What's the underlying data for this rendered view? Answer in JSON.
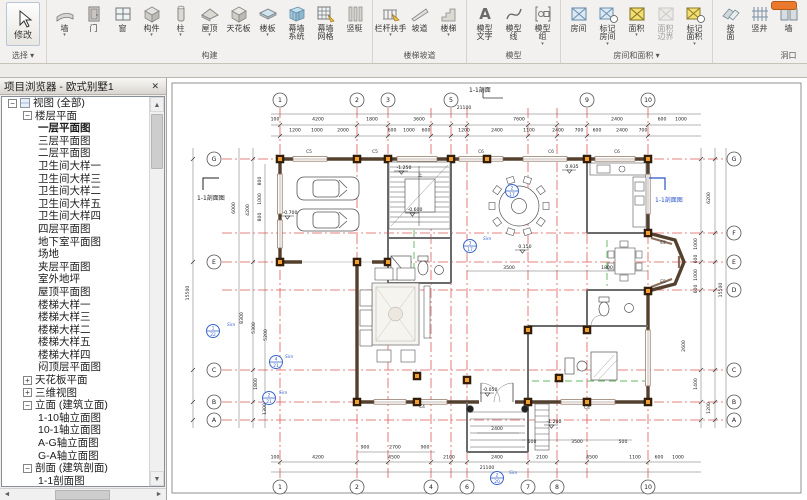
{
  "ribbon": {
    "modify": {
      "label": "修改",
      "select_label": "选择",
      "icon": "modify-cursor-icon"
    },
    "groups": [
      {
        "label": "构建",
        "arrow": false,
        "items": [
          {
            "label": "墙",
            "icon": "wall-icon",
            "arrow": true
          },
          {
            "label": "门",
            "icon": "door-icon",
            "arrow": false
          },
          {
            "label": "窗",
            "icon": "window-icon",
            "arrow": false
          },
          {
            "label": "构件",
            "icon": "component-icon",
            "arrow": true
          },
          {
            "label": "柱",
            "icon": "column-icon",
            "arrow": true
          },
          {
            "label": "屋顶",
            "icon": "roof-icon",
            "arrow": true
          },
          {
            "label": "天花板",
            "icon": "ceiling-icon",
            "arrow": false
          },
          {
            "label": "楼板",
            "icon": "floor-icon",
            "arrow": true
          },
          {
            "label": "幕墙\n系统",
            "icon": "curtain-system-icon",
            "arrow": false
          },
          {
            "label": "幕墙\n网格",
            "icon": "curtain-grid-icon",
            "arrow": false
          },
          {
            "label": "竖梃",
            "icon": "mullion-icon",
            "arrow": false
          }
        ]
      },
      {
        "label": "楼梯坡道",
        "arrow": false,
        "items": [
          {
            "label": "栏杆扶手",
            "icon": "railing-icon",
            "arrow": true
          },
          {
            "label": "坡道",
            "icon": "ramp-icon",
            "arrow": false
          },
          {
            "label": "楼梯",
            "icon": "stair-icon",
            "arrow": true
          }
        ]
      },
      {
        "label": "模型",
        "arrow": false,
        "items": [
          {
            "label": "模型\n文字",
            "icon": "model-text-icon",
            "arrow": false
          },
          {
            "label": "模型\n线",
            "icon": "model-line-icon",
            "arrow": false
          },
          {
            "label": "模型\n组",
            "icon": "model-group-icon",
            "arrow": true
          }
        ]
      },
      {
        "label": "房间和面积",
        "arrow": true,
        "items": [
          {
            "label": "房间",
            "icon": "room-icon",
            "arrow": false
          },
          {
            "label": "标记\n房间",
            "icon": "room-tag-icon",
            "arrow": true
          },
          {
            "label": "面积",
            "icon": "area-icon",
            "arrow": true
          },
          {
            "label": "面积\n边界",
            "icon": "area-boundary-icon",
            "arrow": false,
            "disabled": true
          },
          {
            "label": "标记\n面积",
            "icon": "area-tag-icon",
            "arrow": true
          }
        ]
      },
      {
        "label": "洞口",
        "arrow": false,
        "items": [
          {
            "label": "按\n面",
            "icon": "opening-by-face-icon",
            "arrow": false
          },
          {
            "label": "竖井",
            "icon": "shaft-icon",
            "arrow": false
          },
          {
            "label": "墙",
            "icon": "wall-opening-icon",
            "arrow": false
          },
          {
            "label": "垂直",
            "icon": "vertical-opening-icon",
            "arrow": false
          },
          {
            "label": "老虎窗",
            "icon": "dormer-icon",
            "arrow": false
          }
        ]
      },
      {
        "label": "基准",
        "arrow": false,
        "items": [
          {
            "label": "轴网",
            "icon": "grid-icon",
            "arrow": false
          }
        ]
      }
    ]
  },
  "browser": {
    "title": "项目浏览器 - 欧式别墅1",
    "close_label": "✕",
    "tree": [
      {
        "t": "视图 (全部)",
        "lvl": 0,
        "exp": "-",
        "ico": true
      },
      {
        "t": "楼层平面",
        "lvl": 1,
        "exp": "-"
      },
      {
        "t": "一层平面图",
        "lvl": 2,
        "bold": true
      },
      {
        "t": "三层平面图",
        "lvl": 2
      },
      {
        "t": "二层平面图",
        "lvl": 2
      },
      {
        "t": "卫生间大样一",
        "lvl": 2
      },
      {
        "t": "卫生间大样三",
        "lvl": 2
      },
      {
        "t": "卫生间大样二",
        "lvl": 2
      },
      {
        "t": "卫生间大样五",
        "lvl": 2
      },
      {
        "t": "卫生间大样四",
        "lvl": 2
      },
      {
        "t": "四层平面图",
        "lvl": 2
      },
      {
        "t": "地下室平面图",
        "lvl": 2
      },
      {
        "t": "场地",
        "lvl": 2
      },
      {
        "t": "夹层平面图",
        "lvl": 2
      },
      {
        "t": "室外地坪",
        "lvl": 2
      },
      {
        "t": "屋顶平面图",
        "lvl": 2
      },
      {
        "t": "楼梯大样一",
        "lvl": 2
      },
      {
        "t": "楼梯大样三",
        "lvl": 2
      },
      {
        "t": "楼梯大样二",
        "lvl": 2
      },
      {
        "t": "楼梯大样五",
        "lvl": 2
      },
      {
        "t": "楼梯大样四",
        "lvl": 2
      },
      {
        "t": "闷顶层平面图",
        "lvl": 2
      },
      {
        "t": "天花板平面",
        "lvl": 1,
        "exp": "+"
      },
      {
        "t": "三维视图",
        "lvl": 1,
        "exp": "+"
      },
      {
        "t": "立面 (建筑立面)",
        "lvl": 1,
        "exp": "-"
      },
      {
        "t": "1-10轴立面图",
        "lvl": 2
      },
      {
        "t": "10-1轴立面图",
        "lvl": 2
      },
      {
        "t": "A-G轴立面图",
        "lvl": 2
      },
      {
        "t": "G-A轴立面图",
        "lvl": 2
      },
      {
        "t": "剖面 (建筑剖面)",
        "lvl": 1,
        "exp": "-"
      },
      {
        "t": "1-1剖面图",
        "lvl": 2
      }
    ]
  },
  "plan": {
    "colors": {
      "grid_line": "#e05a5a",
      "callout_blue": "#3a66cc",
      "column_fill": "#f0a030",
      "wall": "#54402e"
    },
    "grids_v": [
      {
        "n": "1",
        "x": 113,
        "top": true,
        "bottom": true
      },
      {
        "n": "2",
        "x": 190,
        "top": true,
        "bottom": true
      },
      {
        "n": "3",
        "x": 221,
        "top": true,
        "bottom": false
      },
      {
        "n": "4",
        "x": 264,
        "top": false,
        "bottom": true
      },
      {
        "n": "5",
        "x": 284,
        "top": true,
        "bottom": false
      },
      {
        "n": "6",
        "x": 300,
        "top": false,
        "bottom": true
      },
      {
        "n": "7",
        "x": 361,
        "top": false,
        "bottom": true
      },
      {
        "n": "8",
        "x": 390,
        "top": false,
        "bottom": true
      },
      {
        "n": "9",
        "x": 420,
        "top": true,
        "bottom": false
      },
      {
        "n": "10",
        "x": 481,
        "top": true,
        "bottom": true
      }
    ],
    "grids_h": [
      {
        "n": "G",
        "y": 81,
        "left": true,
        "right": true
      },
      {
        "n": "F",
        "y": 155,
        "left": false,
        "right": true
      },
      {
        "n": "E",
        "y": 184,
        "left": true,
        "right": true
      },
      {
        "n": "D",
        "y": 212,
        "left": false,
        "right": true
      },
      {
        "n": "C",
        "y": 292,
        "left": true,
        "right": true
      },
      {
        "n": "B",
        "y": 324,
        "left": true,
        "right": true
      },
      {
        "n": "A",
        "y": 342,
        "left": true,
        "right": true
      }
    ],
    "dims": [
      {
        "x": 297,
        "y": 31,
        "t": "21100"
      },
      {
        "x": 108,
        "y": 42.5,
        "t": "100"
      },
      {
        "x": 151,
        "y": 42.5,
        "t": "4200"
      },
      {
        "x": 205,
        "y": 42.5,
        "t": "1800"
      },
      {
        "x": 252,
        "y": 42.5,
        "t": "3600"
      },
      {
        "x": 352,
        "y": 42.5,
        "t": "7600"
      },
      {
        "x": 450,
        "y": 42.5,
        "t": "2400"
      },
      {
        "x": 495,
        "y": 42.5,
        "t": "600"
      },
      {
        "x": 514,
        "y": 42.5,
        "t": "1000"
      },
      {
        "x": 128,
        "y": 53.5,
        "t": "1200"
      },
      {
        "x": 150,
        "y": 53.5,
        "t": "1000"
      },
      {
        "x": 176,
        "y": 53.5,
        "t": "2000"
      },
      {
        "x": 225,
        "y": 53.5,
        "t": "600"
      },
      {
        "x": 242,
        "y": 53.5,
        "t": "1000"
      },
      {
        "x": 259,
        "y": 53.5,
        "t": "600"
      },
      {
        "x": 297,
        "y": 53.5,
        "t": "1200"
      },
      {
        "x": 330,
        "y": 53.5,
        "t": "2400"
      },
      {
        "x": 362,
        "y": 53.5,
        "t": "1100"
      },
      {
        "x": 391,
        "y": 53.5,
        "t": "2400"
      },
      {
        "x": 412,
        "y": 53.5,
        "t": "700"
      },
      {
        "x": 430,
        "y": 53.5,
        "t": "600"
      },
      {
        "x": 455,
        "y": 53.5,
        "t": "2400"
      },
      {
        "x": 476,
        "y": 53.5,
        "t": "700"
      },
      {
        "x": 22,
        "y": 215,
        "t": "15500",
        "r": 1
      },
      {
        "x": 68,
        "y": 130,
        "t": "6000",
        "r": 1
      },
      {
        "x": 82,
        "y": 132,
        "t": "4200",
        "r": 1
      },
      {
        "x": 94,
        "y": 103,
        "t": "800",
        "r": 1
      },
      {
        "x": 94,
        "y": 121,
        "t": "1000",
        "r": 1
      },
      {
        "x": 94,
        "y": 139,
        "t": "800",
        "r": 1
      },
      {
        "x": 76,
        "y": 240,
        "t": "8300",
        "r": 1
      },
      {
        "x": 88,
        "y": 250,
        "t": "5300",
        "r": 1
      },
      {
        "x": 100,
        "y": 257,
        "t": "5200",
        "r": 1
      },
      {
        "x": 90,
        "y": 306,
        "t": "1800",
        "r": 1
      },
      {
        "x": 99,
        "y": 331,
        "t": "1300",
        "r": 1
      },
      {
        "x": 543,
        "y": 120,
        "t": "6200",
        "r": 1
      },
      {
        "x": 530,
        "y": 166,
        "t": "1000",
        "r": 1
      },
      {
        "x": 530,
        "y": 181,
        "t": "600",
        "r": 1
      },
      {
        "x": 530,
        "y": 197,
        "t": "1000",
        "r": 1
      },
      {
        "x": 530,
        "y": 211,
        "t": "600",
        "r": 1
      },
      {
        "x": 555,
        "y": 212,
        "t": "15500",
        "r": 1
      },
      {
        "x": 518,
        "y": 268,
        "t": "2600",
        "r": 1
      },
      {
        "x": 530,
        "y": 306,
        "t": "1400",
        "r": 1
      },
      {
        "x": 543,
        "y": 330,
        "t": "1200",
        "r": 1
      },
      {
        "x": 365,
        "y": 365,
        "t": "500"
      },
      {
        "x": 410,
        "y": 365,
        "t": "3500"
      },
      {
        "x": 456,
        "y": 365,
        "t": "500"
      },
      {
        "x": 198,
        "y": 370.5,
        "t": "900"
      },
      {
        "x": 228,
        "y": 370.5,
        "t": "2700"
      },
      {
        "x": 258,
        "y": 370.5,
        "t": "900"
      },
      {
        "x": 108,
        "y": 380.5,
        "t": "100"
      },
      {
        "x": 151,
        "y": 380.5,
        "t": "4200"
      },
      {
        "x": 227,
        "y": 380.5,
        "t": "4500"
      },
      {
        "x": 282,
        "y": 380.5,
        "t": "2100"
      },
      {
        "x": 330,
        "y": 380.5,
        "t": "2400"
      },
      {
        "x": 375,
        "y": 380.5,
        "t": "2100"
      },
      {
        "x": 425,
        "y": 380.5,
        "t": "4500"
      },
      {
        "x": 468,
        "y": 380.5,
        "t": "1100"
      },
      {
        "x": 492,
        "y": 380.5,
        "t": "600"
      },
      {
        "x": 511,
        "y": 380.5,
        "t": "1000"
      },
      {
        "x": 320,
        "y": 391,
        "t": "21100"
      },
      {
        "x": 330,
        "y": 352,
        "t": "2400"
      },
      {
        "x": 342,
        "y": 191,
        "t": "3500"
      },
      {
        "x": 440,
        "y": 191,
        "t": "1800"
      }
    ],
    "levels": [
      {
        "x": 122,
        "y": 136,
        "t": "-0.700"
      },
      {
        "x": 247,
        "y": 133,
        "t": "-0.600"
      },
      {
        "x": 236,
        "y": 91,
        "t": "-1.250"
      },
      {
        "x": 404,
        "y": 90,
        "t": "0.935"
      },
      {
        "x": 357,
        "y": 170,
        "t": "0.150"
      },
      {
        "x": 322,
        "y": 313,
        "t": "-0.050"
      },
      {
        "x": 386,
        "y": 345,
        "t": "-1.200"
      }
    ],
    "window_tags": [
      {
        "x": 142,
        "y": 75,
        "t": "C5"
      },
      {
        "x": 208,
        "y": 75,
        "t": "C5"
      },
      {
        "x": 314,
        "y": 75,
        "t": "C6"
      },
      {
        "x": 384,
        "y": 75,
        "t": "C6"
      },
      {
        "x": 450,
        "y": 75,
        "t": "C6"
      },
      {
        "x": 496,
        "y": 166,
        "t": "E5"
      },
      {
        "x": 496,
        "y": 205,
        "t": "E5"
      },
      {
        "x": 420,
        "y": 331,
        "t": "C4"
      },
      {
        "x": 255,
        "y": 330,
        "t": "C4"
      }
    ],
    "callouts": [
      {
        "x": 46,
        "y": 253,
        "a": "1",
        "b": "22"
      },
      {
        "x": 345,
        "y": 113,
        "a": "2",
        "b": "17"
      },
      {
        "x": 303,
        "y": 168,
        "a": "3",
        "b": "17"
      },
      {
        "x": 109,
        "y": 284,
        "a": "4",
        "b": "21"
      },
      {
        "x": 102,
        "y": 320,
        "a": "2",
        "b": "21"
      },
      {
        "x": 330,
        "y": 400,
        "a": "2",
        "b": "20"
      }
    ],
    "sims": [
      {
        "x": 60,
        "y": 248,
        "t": "Sim"
      },
      {
        "x": 316,
        "y": 162,
        "t": "Sim"
      },
      {
        "x": 118,
        "y": 280,
        "t": "Sim"
      },
      {
        "x": 112,
        "y": 316,
        "t": "Sim"
      },
      {
        "x": 342,
        "y": 396,
        "t": "Sim"
      }
    ],
    "section_labels": [
      {
        "x": 30,
        "y": 122,
        "t": "1-1剖面图",
        "c": "#1a1a1a"
      },
      {
        "x": 488,
        "y": 124,
        "t": "1-1剖面图",
        "c": "#2b55c8"
      },
      {
        "x": 302,
        "y": 14,
        "t": "1-1剖面",
        "c": "#1a1a1a"
      }
    ],
    "stair_up_label": "上"
  }
}
